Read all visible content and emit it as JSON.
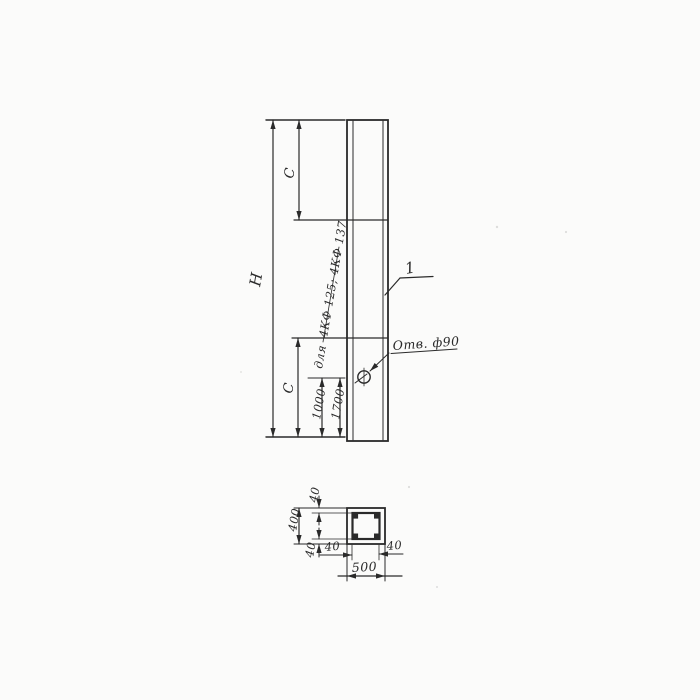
{
  "colors": {
    "ink": "#2a2a2a",
    "paper": "#fbfbfa"
  },
  "elevation": {
    "dim_height_label": "Н",
    "dim_c_top_label": "С",
    "dim_c_bottom_label": "С",
    "dim_1000_label": "1000",
    "dim_1700_label": "1700",
    "variant_for_word": "для",
    "variant_models": "4КФ 125; 4КФ 137",
    "hole_label": "Отв. ф90",
    "part_number": "1"
  },
  "section": {
    "width_label": "500",
    "height_label": "400",
    "cover_top_label": "40",
    "cover_bottom_label": "40",
    "cover_left_label": "40",
    "cover_right_label": "40"
  }
}
